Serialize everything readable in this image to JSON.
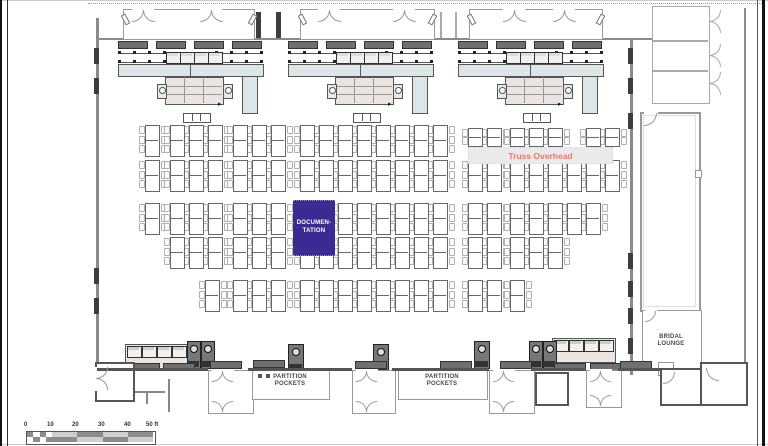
{
  "labels": {
    "documentation_line1": "DOCUMEN-",
    "documentation_line2": "TATION",
    "truss_overhead": "Truss Overhead",
    "bridal_line1": "BRIDAL",
    "bridal_line2": "LOUNGE",
    "partition_line1": "PARTITION",
    "partition_line2": "POCKETS"
  },
  "scale_bar": {
    "labels": [
      "0",
      "10",
      "20",
      "30",
      "40",
      "50 ft"
    ],
    "unit_ft": 10
  },
  "colors": {
    "documentation_fill": "#3a2b92",
    "documentation_text": "#ffffff",
    "truss_text": "#f0746c",
    "truss_band": "#eaeaea",
    "wall": "#8a8a8a",
    "wall_dark": "#3d3d3d",
    "counter": "#dce6e6",
    "table_block": "#eae5e1",
    "chair_border": "#b0b0b0",
    "table_border": "#666666",
    "label_text": "#4a4a4a",
    "scale_dark": "#8c8c8c",
    "scale_light": "#cfcfcf"
  },
  "layout": {
    "frame": {
      "left1": [
        0,
        2
      ],
      "left2": [
        7,
        1
      ],
      "right1": [
        757,
        1
      ],
      "right2": [
        762,
        3
      ]
    },
    "top_dotted": {
      "y": 3,
      "x1": 88,
      "x2": 762
    },
    "walls": {
      "left_wall": {
        "x": 96,
        "y1": 18,
        "y2": 378
      },
      "left_markers_y": [
        48,
        78,
        268,
        298
      ],
      "top_wall": {
        "y": 38,
        "x1": 96,
        "x2": 655
      },
      "right_wall": {
        "x": 630,
        "y1": 40,
        "y2": 375
      },
      "right_markers_y": [
        48,
        78,
        113,
        253,
        281,
        308,
        338
      ],
      "bottom_wall_y": 368,
      "bottom_segments": [
        [
          96,
          208
        ],
        [
          248,
          352
        ],
        [
          392,
          489
        ],
        [
          531,
          586
        ],
        [
          618,
          662
        ]
      ],
      "corridor_bars_x": [
        256,
        276
      ],
      "corridor_lines_x": [
        440,
        455
      ],
      "outer_right_wall": {
        "x": 744,
        "y1": 8,
        "y2": 404
      },
      "bottom_right_wall": {
        "y": 404,
        "x1": 690,
        "x2": 744
      },
      "partial_lines": [
        [
          128,
          391,
          165,
          391
        ],
        [
          146,
          391,
          146,
          404
        ],
        [
          168,
          379,
          168,
          412
        ]
      ]
    },
    "vestibules": [
      {
        "x": 123,
        "w": 130,
        "pairs": [
          9,
          77
        ]
      },
      {
        "x": 300,
        "w": 133,
        "pairs": [
          18,
          93
        ]
      },
      {
        "x": 469,
        "w": 132,
        "pairs": [
          34,
          84
        ]
      }
    ],
    "stations_x": [
      118,
      288,
      458
    ],
    "tables": {
      "rows": [
        {
          "y": 125,
          "xs": [
            145,
            170,
            189,
            208,
            233,
            252,
            271,
            300,
            319,
            338,
            357,
            376,
            395,
            414,
            433
          ]
        },
        {
          "y": 128,
          "short": true,
          "xs": [
            468,
            487,
            510,
            529,
            548,
            586,
            605
          ]
        },
        {
          "y": 160,
          "xs": [
            145,
            170,
            189,
            208,
            233,
            252,
            271,
            300,
            319,
            338,
            357,
            376,
            395,
            414,
            433,
            468,
            487,
            510,
            529,
            548,
            567,
            586,
            605
          ]
        },
        {
          "y": 203,
          "xs": [
            145,
            170,
            189,
            208,
            233,
            252,
            271,
            338,
            357,
            376,
            395,
            414,
            433,
            468,
            487,
            510,
            529,
            548,
            567,
            586
          ]
        },
        {
          "y": 237,
          "xs": [
            170,
            189,
            208,
            233,
            252,
            271,
            300,
            319,
            338,
            357,
            376,
            395,
            414,
            433,
            468,
            487,
            510,
            529,
            548
          ]
        },
        {
          "y": 280,
          "xs": [
            205,
            233,
            252,
            271,
            300,
            319,
            338,
            357,
            376,
            395,
            414,
            433,
            468,
            487,
            510
          ]
        }
      ]
    },
    "doc_block": {
      "x": 293,
      "y": 200,
      "w": 42,
      "h": 54
    },
    "truss_band": {
      "x": 468,
      "y": 147,
      "w": 143,
      "h": 15
    },
    "rooms_top_right": {
      "x": 652,
      "y": 6,
      "w": 56,
      "dividers": [
        40,
        70
      ],
      "h": 96
    },
    "big_room": {
      "x": 640,
      "y": 112,
      "w": 57,
      "h": 196
    },
    "bridal_room": {
      "x": 642,
      "y": 310,
      "w": 58,
      "h": 57
    },
    "bottom": {
      "buffets": [
        {
          "x": 125,
          "y": 344
        },
        {
          "x": 552,
          "y": 338
        }
      ],
      "coffee_pairs": [
        {
          "x": 187,
          "y": 341
        },
        {
          "x": 529,
          "y": 341
        }
      ],
      "coffee_singles": [
        {
          "x": 288,
          "y": 344
        },
        {
          "x": 373,
          "y": 344
        },
        {
          "x": 474,
          "y": 341
        }
      ],
      "mats": [
        [
          128,
          363
        ],
        [
          163,
          363
        ],
        [
          210,
          361
        ],
        [
          253,
          360
        ],
        [
          355,
          361
        ],
        [
          440,
          361
        ],
        [
          500,
          361
        ],
        [
          554,
          363
        ],
        [
          590,
          363
        ],
        [
          620,
          361
        ]
      ],
      "corner_room": {
        "x": 95,
        "y": 362,
        "w": 36,
        "h": 36
      },
      "door_vestibules": [
        {
          "x": 208,
          "y": 370,
          "w": 44,
          "h": 42
        },
        {
          "x": 352,
          "y": 370,
          "w": 42,
          "h": 42
        },
        {
          "x": 489,
          "y": 370,
          "w": 44,
          "h": 42
        },
        {
          "x": 586,
          "y": 370,
          "w": 34,
          "h": 36
        }
      ],
      "pp_rooms": [
        {
          "x": 252,
          "y": 368,
          "w": 76,
          "h": 30
        },
        {
          "x": 398,
          "y": 368,
          "w": 88,
          "h": 30
        }
      ],
      "small_room": {
        "x": 535,
        "y": 372,
        "w": 30,
        "h": 30
      },
      "hall_vest": {
        "x": 660,
        "y": 368,
        "w": 38,
        "h": 34
      },
      "bridal_entry": {
        "x": 700,
        "y": 362,
        "w": 44,
        "h": 40
      }
    },
    "scale_bar": {
      "x": 27,
      "y": 432,
      "seg_w": 25.2,
      "row_h": 5,
      "label_y": 422,
      "label_xs": [
        24,
        47,
        72,
        98,
        124,
        146
      ]
    }
  }
}
